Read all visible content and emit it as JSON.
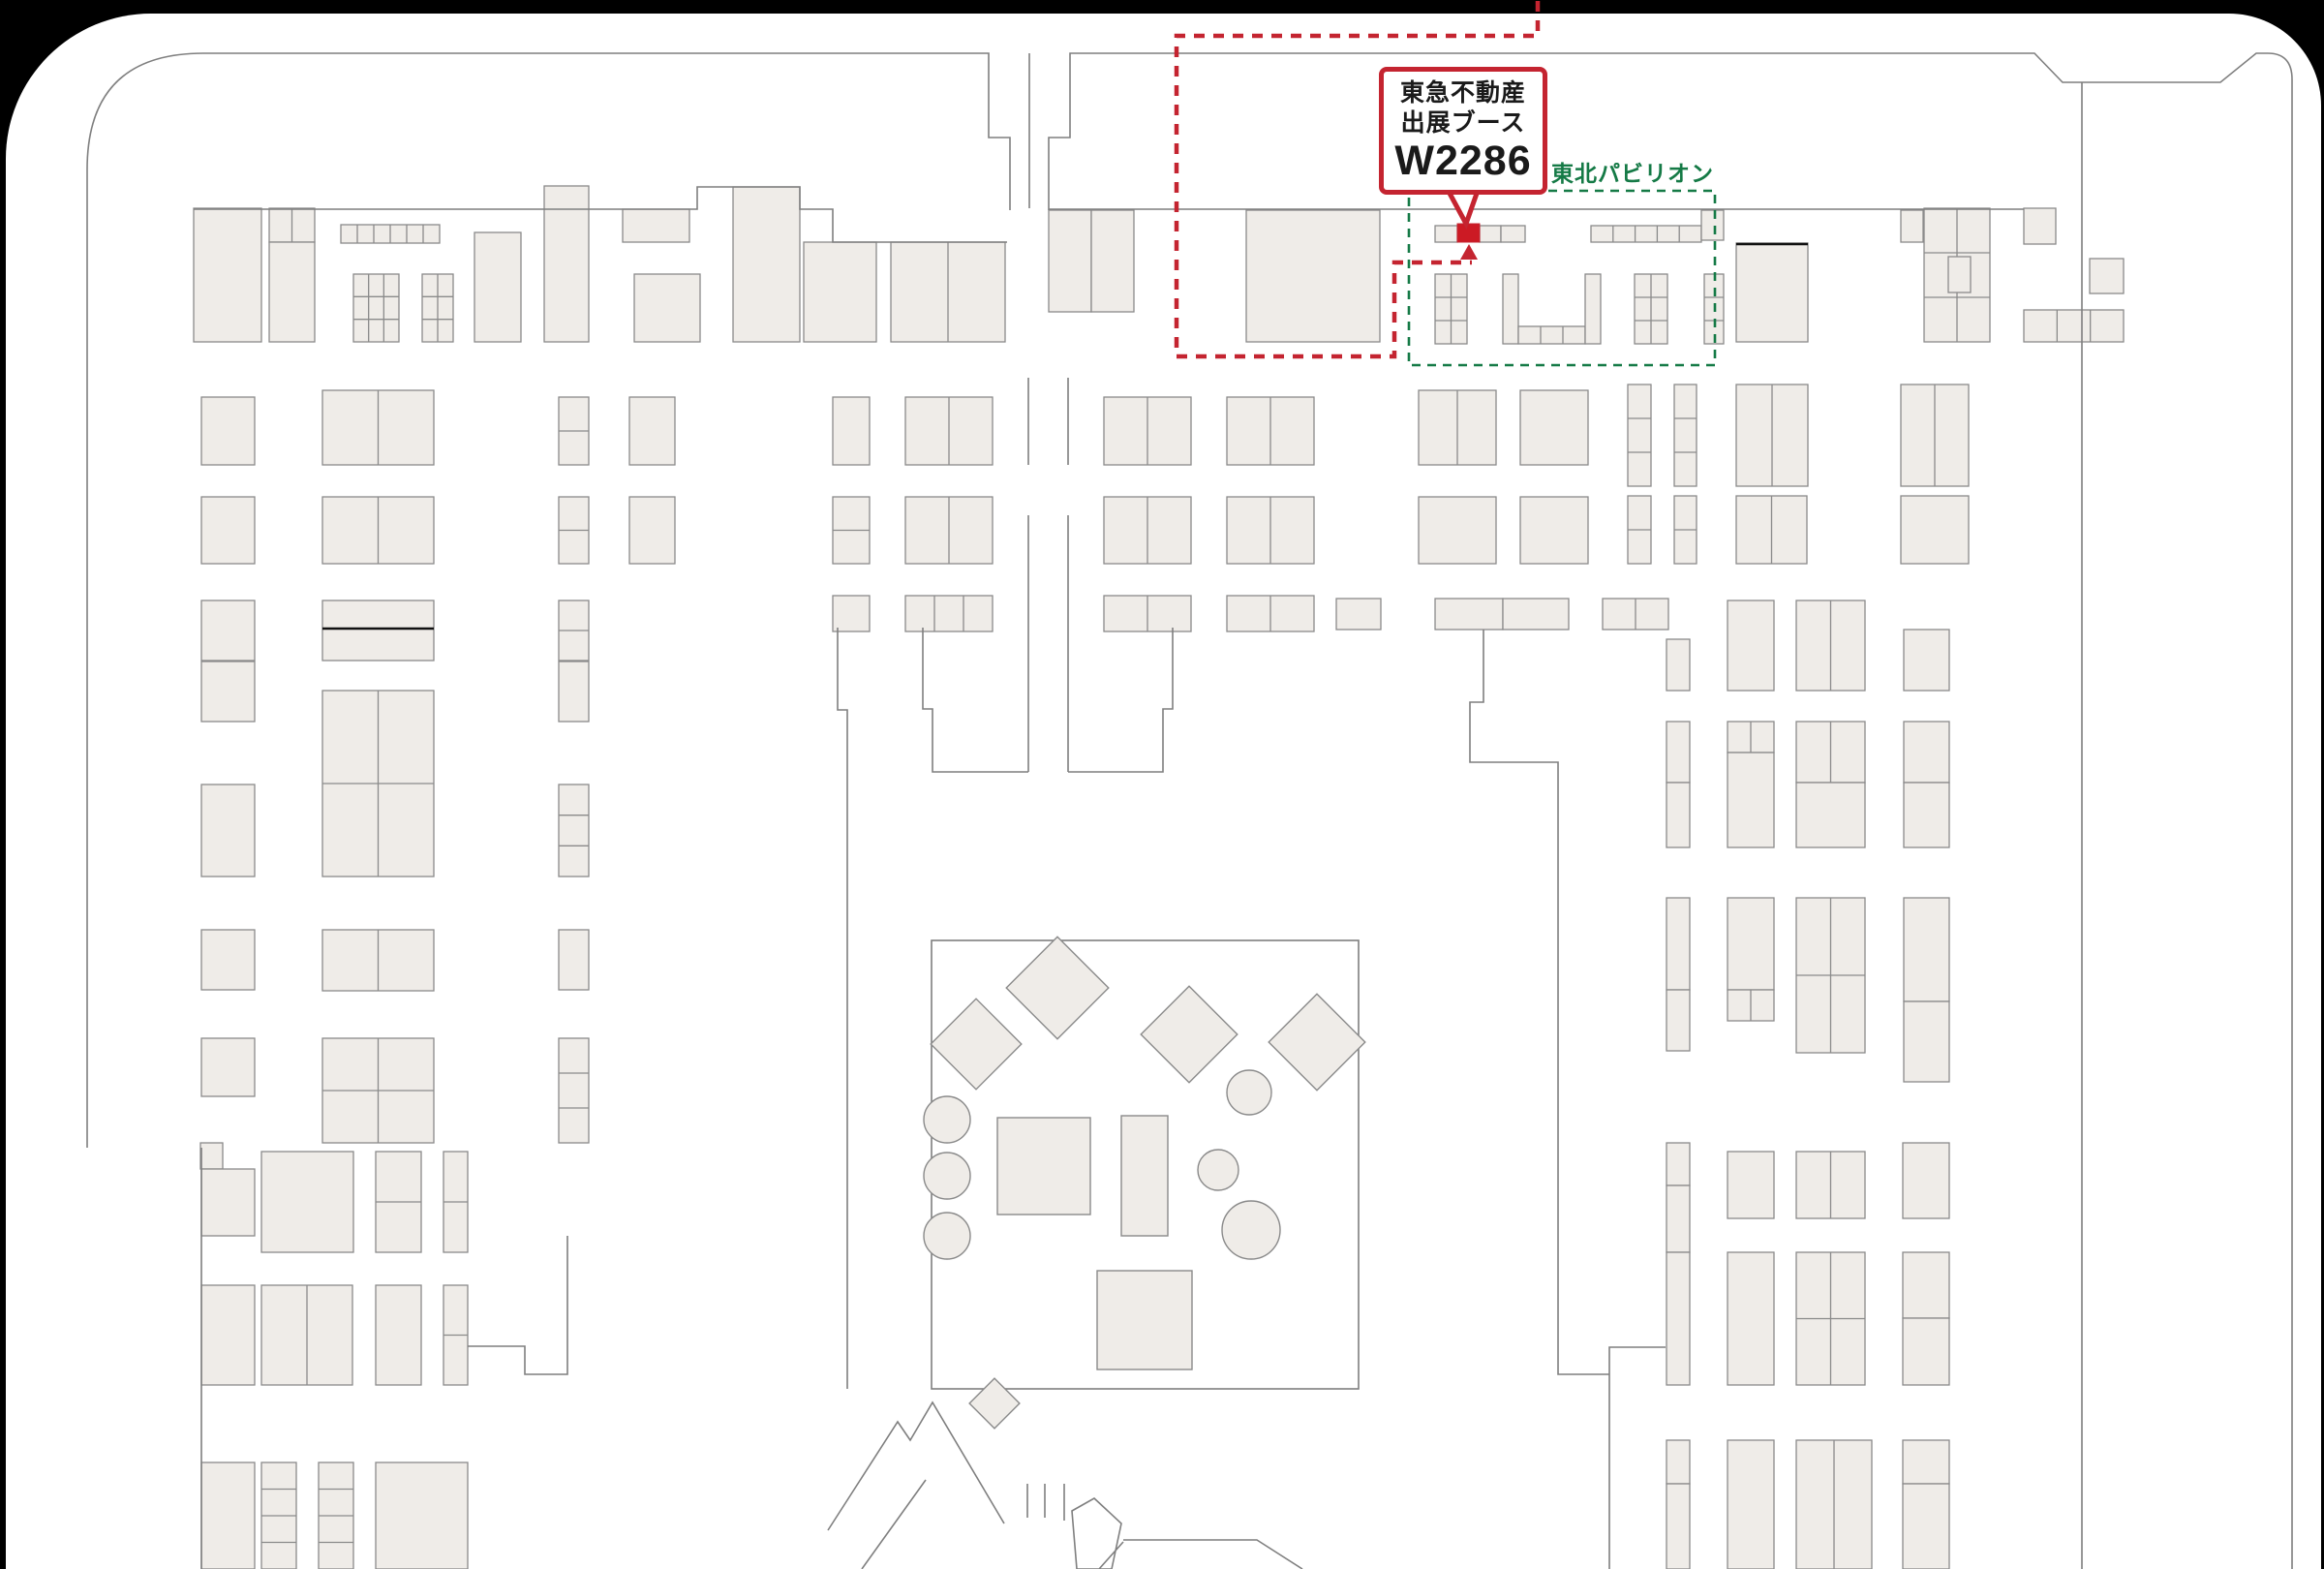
{
  "callout": {
    "line1": "東急不動産",
    "line2": "出展ブース",
    "booth_no": "W2286"
  },
  "pavilion": {
    "label": "東北パビリオン"
  },
  "colors": {
    "page_bg": "#ffffff",
    "canvas_bg": "#000000",
    "booth_fill": "#efece8",
    "booth_stroke": "#8a8a8a",
    "wall": "#7f7f7f",
    "red": "#c42430",
    "red_booth_fill": "#cc1a24",
    "green": "#157a46",
    "black_line": "#111111"
  },
  "map": {
    "booths": [
      [
        200,
        215,
        70,
        138
      ],
      [
        278,
        215,
        47,
        35,
        1,
        2
      ],
      [
        278,
        250,
        47,
        103
      ],
      [
        352,
        232,
        102,
        19,
        1,
        6
      ],
      [
        365,
        283,
        47,
        70,
        3,
        3
      ],
      [
        436,
        283,
        32,
        70,
        3,
        2
      ],
      [
        490,
        240,
        48,
        113
      ],
      [
        562,
        192,
        46,
        161
      ],
      [
        643,
        216,
        69,
        34
      ],
      [
        655,
        283,
        68,
        70
      ],
      [
        757,
        193,
        69,
        160
      ],
      [
        830,
        250,
        75,
        103
      ],
      [
        920,
        250,
        118,
        103,
        1,
        2
      ],
      [
        1083,
        217,
        44,
        105
      ],
      [
        1127,
        217,
        44,
        105
      ],
      [
        1287,
        217,
        138,
        136
      ],
      [
        1482,
        233,
        23,
        17
      ],
      [
        1528,
        233,
        22,
        17
      ],
      [
        1550,
        233,
        25,
        17
      ],
      [
        1643,
        233,
        114,
        17,
        1,
        5
      ],
      [
        1757,
        217,
        23,
        31
      ],
      [
        1482,
        283,
        33,
        72,
        3,
        2
      ],
      [
        1552,
        283,
        16,
        72
      ],
      [
        1568,
        337,
        69,
        18,
        1,
        3
      ],
      [
        1637,
        283,
        16,
        72
      ],
      [
        1688,
        283,
        34,
        72,
        3,
        2
      ],
      [
        1760,
        283,
        20,
        72,
        3,
        1
      ],
      [
        1793,
        251,
        74,
        102
      ],
      [
        1987,
        215,
        68,
        138,
        3,
        2
      ],
      [
        2090,
        215,
        33,
        37
      ],
      [
        1963,
        217,
        23,
        33
      ],
      [
        2012,
        265,
        23,
        37
      ],
      [
        2158,
        267,
        35,
        36
      ],
      [
        2090,
        320,
        103,
        33,
        1,
        3
      ],
      [
        208,
        410,
        55,
        70
      ],
      [
        333,
        403,
        115,
        77,
        1,
        2
      ],
      [
        577,
        410,
        31,
        70,
        2,
        1
      ],
      [
        650,
        410,
        47,
        70
      ],
      [
        860,
        410,
        38,
        70
      ],
      [
        935,
        410,
        90,
        70,
        1,
        2
      ],
      [
        1140,
        410,
        90,
        70,
        1,
        2
      ],
      [
        1267,
        410,
        90,
        70,
        1,
        2
      ],
      [
        1465,
        403,
        80,
        77,
        1,
        2
      ],
      [
        1570,
        403,
        70,
        77
      ],
      [
        1681,
        397,
        24,
        105,
        3,
        1
      ],
      [
        1729,
        397,
        23,
        105,
        3,
        1
      ],
      [
        1793,
        397,
        74,
        105,
        1,
        2
      ],
      [
        1963,
        397,
        70,
        105,
        1,
        2
      ],
      [
        208,
        513,
        55,
        69
      ],
      [
        333,
        513,
        115,
        69,
        1,
        2
      ],
      [
        577,
        513,
        31,
        69,
        2,
        1
      ],
      [
        650,
        513,
        47,
        69
      ],
      [
        860,
        513,
        38,
        69,
        2,
        1
      ],
      [
        935,
        513,
        90,
        69,
        1,
        2
      ],
      [
        1140,
        513,
        90,
        69,
        1,
        2
      ],
      [
        1267,
        513,
        90,
        69,
        1,
        2
      ],
      [
        1465,
        513,
        80,
        69
      ],
      [
        1570,
        513,
        70,
        69
      ],
      [
        1681,
        512,
        24,
        70,
        2,
        1
      ],
      [
        1729,
        512,
        23,
        70,
        2,
        1
      ],
      [
        1793,
        512,
        73,
        70,
        1,
        2
      ],
      [
        1963,
        512,
        70,
        70
      ],
      [
        208,
        620,
        55,
        62
      ],
      [
        333,
        620,
        115,
        62
      ],
      [
        577,
        620,
        31,
        62,
        2,
        1
      ],
      [
        860,
        615,
        38,
        37
      ],
      [
        935,
        615,
        90,
        37,
        1,
        3
      ],
      [
        1140,
        615,
        90,
        37,
        1,
        2
      ],
      [
        1267,
        615,
        90,
        37,
        1,
        2
      ],
      [
        1380,
        618,
        46,
        32
      ],
      [
        1482,
        618,
        70,
        32
      ],
      [
        1552,
        618,
        68,
        32
      ],
      [
        1655,
        618,
        68,
        32,
        1,
        2
      ],
      [
        208,
        683,
        55,
        62
      ],
      [
        208,
        810,
        55,
        95
      ],
      [
        333,
        713,
        115,
        192,
        2,
        2
      ],
      [
        577,
        683,
        31,
        62
      ],
      [
        577,
        810,
        31,
        95,
        3,
        1
      ],
      [
        208,
        960,
        55,
        62
      ],
      [
        333,
        960,
        115,
        63,
        1,
        2
      ],
      [
        577,
        960,
        31,
        62
      ],
      [
        208,
        1072,
        55,
        60
      ],
      [
        333,
        1072,
        115,
        108,
        2,
        2
      ],
      [
        577,
        1072,
        31,
        108,
        3,
        1
      ],
      [
        1721,
        660,
        24,
        53
      ],
      [
        1784,
        620,
        48,
        93
      ],
      [
        1855,
        620,
        71,
        93,
        1,
        2
      ],
      [
        1966,
        650,
        47,
        63
      ],
      [
        1721,
        745,
        24,
        63
      ],
      [
        1721,
        808,
        24,
        67
      ],
      [
        1784,
        745,
        48,
        32,
        1,
        2
      ],
      [
        1784,
        777,
        48,
        98
      ],
      [
        1855,
        745,
        71,
        63,
        1,
        2
      ],
      [
        1855,
        808,
        71,
        67
      ],
      [
        1966,
        745,
        47,
        63
      ],
      [
        1966,
        808,
        47,
        67
      ],
      [
        1721,
        927,
        24,
        95
      ],
      [
        1721,
        1022,
        24,
        63
      ],
      [
        1784,
        927,
        48,
        95
      ],
      [
        1784,
        1022,
        48,
        32,
        1,
        2
      ],
      [
        1855,
        927,
        71,
        160,
        2,
        2
      ],
      [
        1966,
        927,
        47,
        107
      ],
      [
        1966,
        1034,
        47,
        83
      ],
      [
        207,
        1180,
        23,
        27
      ],
      [
        208,
        1207,
        55,
        69
      ],
      [
        270,
        1189,
        95,
        104
      ],
      [
        388,
        1189,
        47,
        104,
        2,
        1
      ],
      [
        458,
        1189,
        25,
        104,
        2,
        1
      ],
      [
        208,
        1327,
        55,
        103
      ],
      [
        270,
        1327,
        94,
        103,
        1,
        2
      ],
      [
        388,
        1327,
        47,
        103
      ],
      [
        458,
        1327,
        25,
        103,
        2,
        1
      ],
      [
        208,
        1510,
        55,
        110
      ],
      [
        270,
        1510,
        36,
        110,
        4,
        1
      ],
      [
        329,
        1510,
        36,
        110,
        4,
        1
      ],
      [
        388,
        1510,
        95,
        110
      ],
      [
        1721,
        1180,
        24,
        44
      ],
      [
        1721,
        1224,
        24,
        69
      ],
      [
        1784,
        1189,
        48,
        69
      ],
      [
        1855,
        1189,
        71,
        69,
        1,
        2
      ],
      [
        1965,
        1180,
        48,
        78
      ],
      [
        1721,
        1293,
        24,
        137
      ],
      [
        1784,
        1293,
        48,
        137
      ],
      [
        1855,
        1293,
        71,
        137,
        2,
        2
      ],
      [
        1965,
        1293,
        48,
        68
      ],
      [
        1965,
        1361,
        48,
        69
      ],
      [
        1721,
        1487,
        24,
        45
      ],
      [
        1721,
        1532,
        24,
        88
      ],
      [
        1784,
        1487,
        48,
        133
      ],
      [
        1855,
        1487,
        78,
        133,
        1,
        2
      ],
      [
        1965,
        1487,
        48,
        45
      ],
      [
        1965,
        1532,
        48,
        88
      ]
    ],
    "red_booth": [
      1505,
      231,
      23,
      19
    ],
    "marker_triangle": "1508,268 1526,268 1517,252",
    "tail": "M 1494,194 L 1514,231 L 1527,194",
    "red_dash_path": "M 1588,1 L 1588,37 L 1215,37 L 1215,368 L 1440,368 L 1440,271 L 1520,271",
    "green_rect": [
      1455,
      197,
      316,
      180
    ],
    "courtyard": [
      962,
      971,
      441,
      463
    ],
    "courtyard_rects": [
      [
        1030,
        1154,
        96,
        100
      ],
      [
        1158,
        1152,
        48,
        124
      ],
      [
        1133,
        1312,
        98,
        102
      ]
    ],
    "diamonds": [
      [
        1008,
        1078,
        47
      ],
      [
        1092,
        1020,
        53
      ],
      [
        1228,
        1068,
        50
      ],
      [
        1360,
        1076,
        50
      ],
      [
        1027,
        1449,
        26
      ]
    ],
    "circles": [
      [
        978,
        1156,
        24
      ],
      [
        978,
        1214,
        24
      ],
      [
        978,
        1276,
        24
      ],
      [
        1290,
        1128,
        23
      ],
      [
        1258,
        1208,
        21
      ],
      [
        1292,
        1270,
        30
      ]
    ],
    "black_lines": [
      [
        333,
        649,
        448,
        649
      ],
      [
        1793,
        252,
        1867,
        252
      ]
    ],
    "walls": [
      "M 90,1185 L 90,175 Q 90,55 210,55 L 1021,55 L 1021,142 L 1043,142 L 1043,217 M 1063,55 L 1063,215 M 1083,217 L 1083,142 L 1105,142 L 1105,55 L 2101,55 L 2130,85 L 2293,85 L 2330,55 L 2342,55 Q 2367,55 2367,82 L 2367,1620",
      "M 2150,85 L 2150,1620",
      "M 208,1185 L 208,1620",
      "M 200,216 L 720,216 L 720,193 L 826,193 L 826,216 L 860,216 L 860,250 L 1040,250",
      "M 1083,216 L 2090,216",
      "M 1062,390 L 1062,480 M 1103,390 L 1103,480 M 1062,532 L 1062,797 M 1103,532 L 1103,797",
      "M 953,648 L 953,732 L 963,732 L 963,797 L 1062,797 M 1103,797 L 1201,797 L 1201,732 L 1211,732 L 1211,648",
      "M 865,648 L 865,733 L 875,733 L 875,797 L 875,1434",
      "M 1532,650 L 1532,725 L 1518,725 L 1518,787 L 1609,787 L 1609,1419 L 1662,1419 L 1662,1391 L 1720,1391 M 1662,1419 L 1662,1620",
      "M 586,1276 L 586,1419 L 542,1419 L 542,1390 L 483,1390",
      "M 855,1580 L 927,1468 L 940,1487 L 963,1448 L 1037,1573 M 890,1620 L 956,1528 M 1061,1532 L 1061,1567 M 1079,1532 L 1079,1567 M 1099,1532 L 1099,1570 M 1107,1560 L 1130,1547 L 1158,1573 L 1148,1620 L 1112,1620 Z M 1160,1590 L 1298,1590 L 1345,1620 M 1135,1620 L 1160,1592"
    ]
  }
}
